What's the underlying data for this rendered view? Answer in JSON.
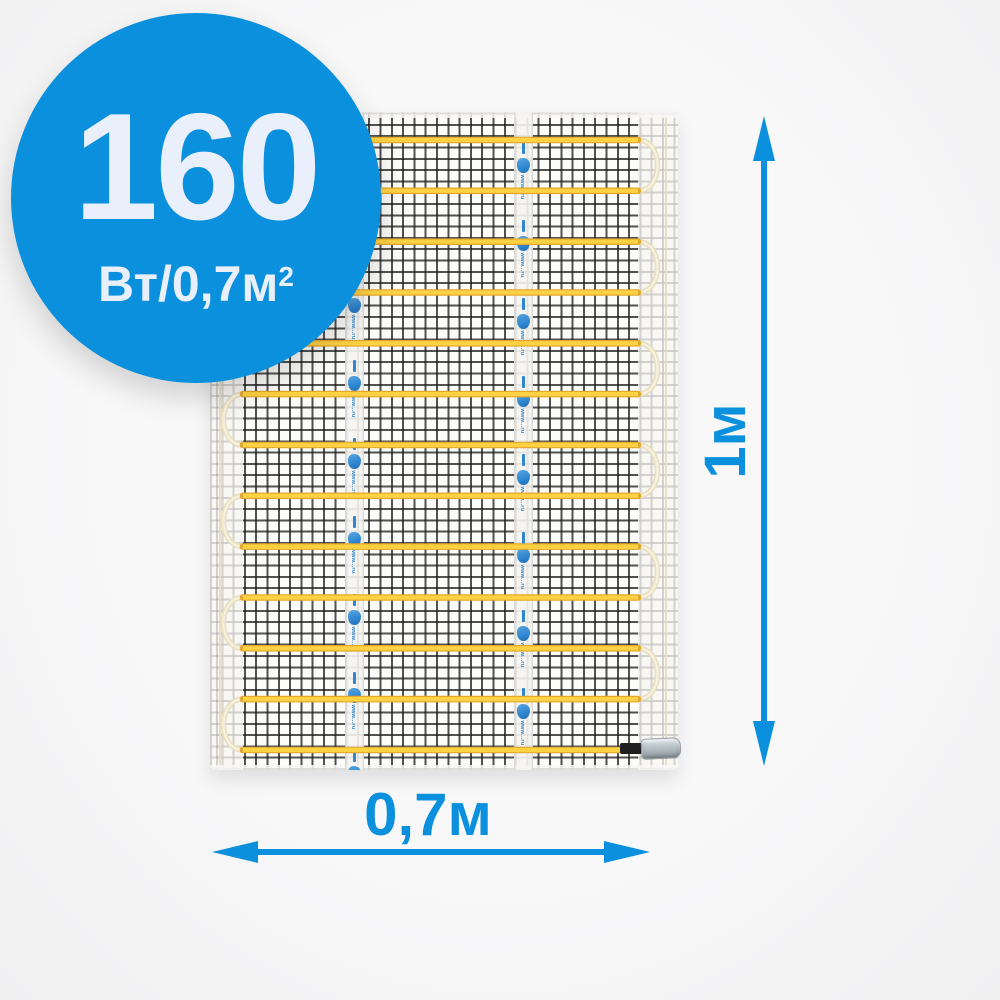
{
  "badge": {
    "value": "160",
    "unit_base": "Вт/0,7м",
    "unit_exponent": "2"
  },
  "dimensions": {
    "height": {
      "label": "1м"
    },
    "width": {
      "label": "0,7м"
    }
  },
  "mat": {
    "tape_text": "www...ru",
    "cable_runs": 13,
    "tape_strips": 2
  },
  "colors": {
    "accent_blue": "#0a90dd",
    "badge_fill": "#0a90dd",
    "badge_text": "#e9effb",
    "tape_blue": "#2f86cf",
    "cable_yellow": "#ffd243",
    "cable_yellow_edge": "#e2a82d",
    "cable_turn": "#e8dec0",
    "cable_turn_light": "#f7f1df",
    "mesh_line": "#202020",
    "mat_base": "#fcfcfb",
    "connector_black": "#1f1f1f",
    "connector_silver": "#b7bfc5",
    "background": "#f4f4f5"
  }
}
